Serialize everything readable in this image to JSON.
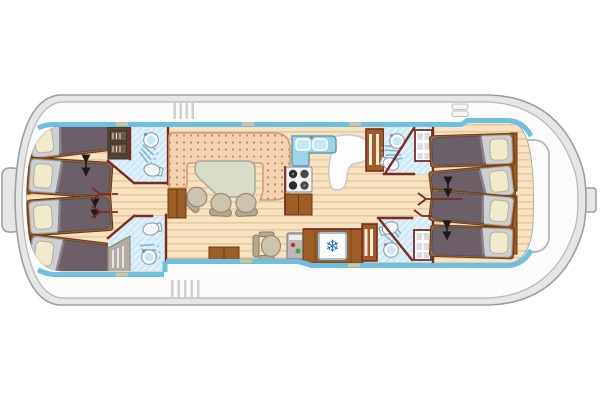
{
  "plan": {
    "type": "boat-floor-plan",
    "bow_section": {
      "cabins": 2,
      "beds": 4,
      "bathrooms": 2
    },
    "stern_section": {
      "cabins": 2,
      "beds": 4,
      "bathrooms": 2
    },
    "bathroom_fixtures": [
      "shower",
      "washbasin",
      "toilet",
      "wardrobe"
    ],
    "salon": {
      "sofa": "u-shaped-dotted",
      "table": 1,
      "chairs": 3
    },
    "galley": {
      "sink_bowls": 2,
      "stove_burners": 4,
      "base_cabinet": true,
      "counter": true
    },
    "helm": {
      "seat": 1,
      "control_console": true,
      "fridge": true
    },
    "decks": {
      "side_walkways": 2,
      "entry_steps": 2,
      "stern_hatch": true,
      "bow_fender": true,
      "rudder_stub": true
    }
  },
  "icons": {
    "fridge_snowflake": "❄"
  },
  "colors": {
    "hull_outline": "#9e9e9e",
    "hull_fill": "#e6e6e6",
    "deck_fill": "#fbfbfb",
    "deck_line": "#b6b6b6",
    "stripe": "#6fc0e0",
    "floor": "#f7e3c1",
    "floor_line": "#e7cb9e",
    "wall": "#7c2b22",
    "wood": "#9c5e26",
    "wood_dark": "#673912",
    "sofa": "#f4d3b3",
    "sofa_dot": "#c9825c",
    "sofa_edge": "#d19b72",
    "table": "#d9dcc8",
    "table_edge": "#a6a994",
    "chair": "#cdc4b0",
    "chair_dark": "#968b74",
    "bed_blanket": "#6c5f67",
    "bed_blanket_edge": "#8d8089",
    "bed_mattress": "#cbd0d4",
    "pillow": "#f1eacd",
    "bath": "#cfe9f6",
    "bath_spray": "#7fb3cb",
    "counter": "#9fd4e8",
    "counter_edge": "#5e9cb8",
    "sink_fill": "#c6e8f6",
    "burner_dark": "#2d2d2d",
    "burner_gray": "#4a4a4a",
    "fridge_accent": "#1f6fd0",
    "console": "#b9b9b9",
    "console_red": "#cf2b2b",
    "console_green": "#3fae3f",
    "arrow": "#1a1a1a",
    "dark_cabinet": "#564437",
    "step": "#cfcfcf",
    "hatch_line": "#b4b4b4",
    "cleat": "#dbc295"
  }
}
